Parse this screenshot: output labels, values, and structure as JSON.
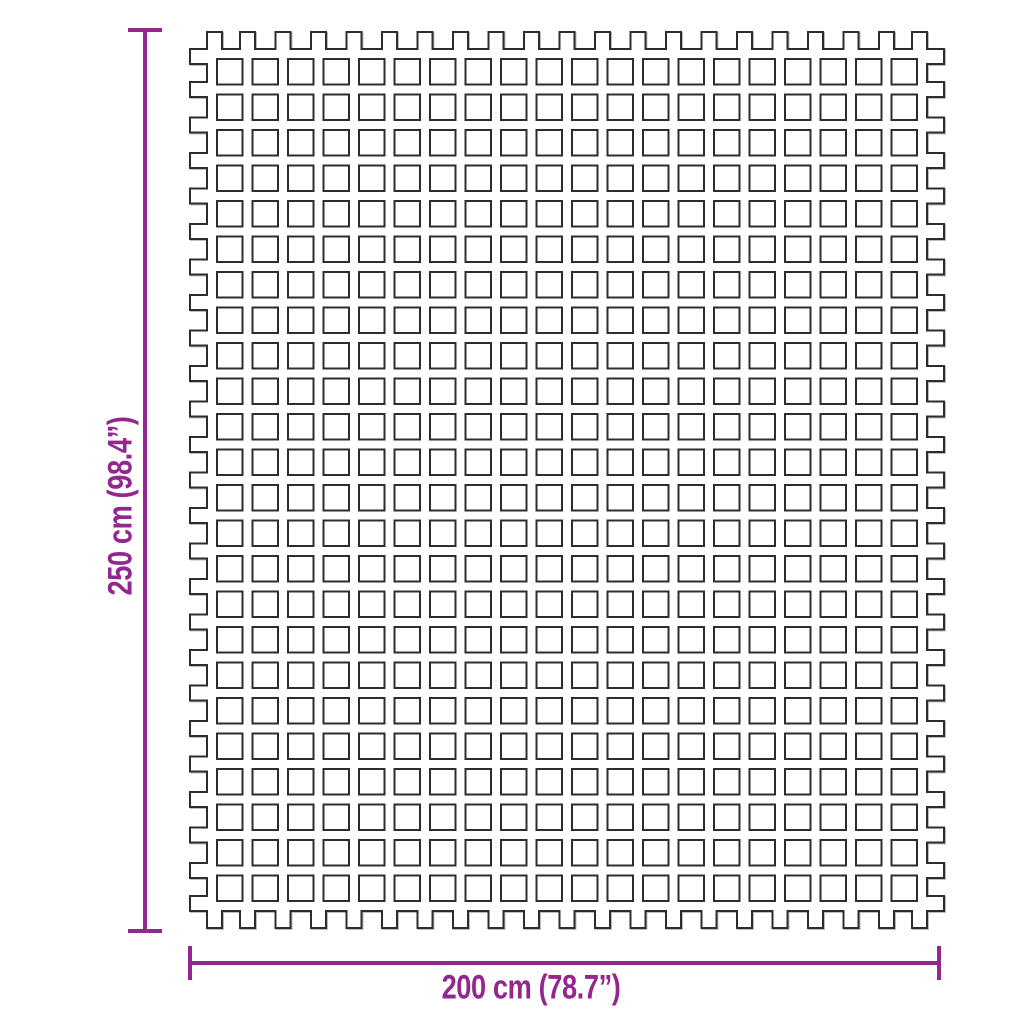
{
  "diagram": {
    "background": "#ffffff",
    "accent_color": "#93278F",
    "line_color": "#2d2d2d",
    "dimensions": {
      "vertical": {
        "label": "250 cm (98.4”)"
      },
      "horizontal": {
        "label": "200 cm (78.7”)"
      }
    },
    "mat": {
      "rows": 24,
      "cols": 20
    }
  }
}
